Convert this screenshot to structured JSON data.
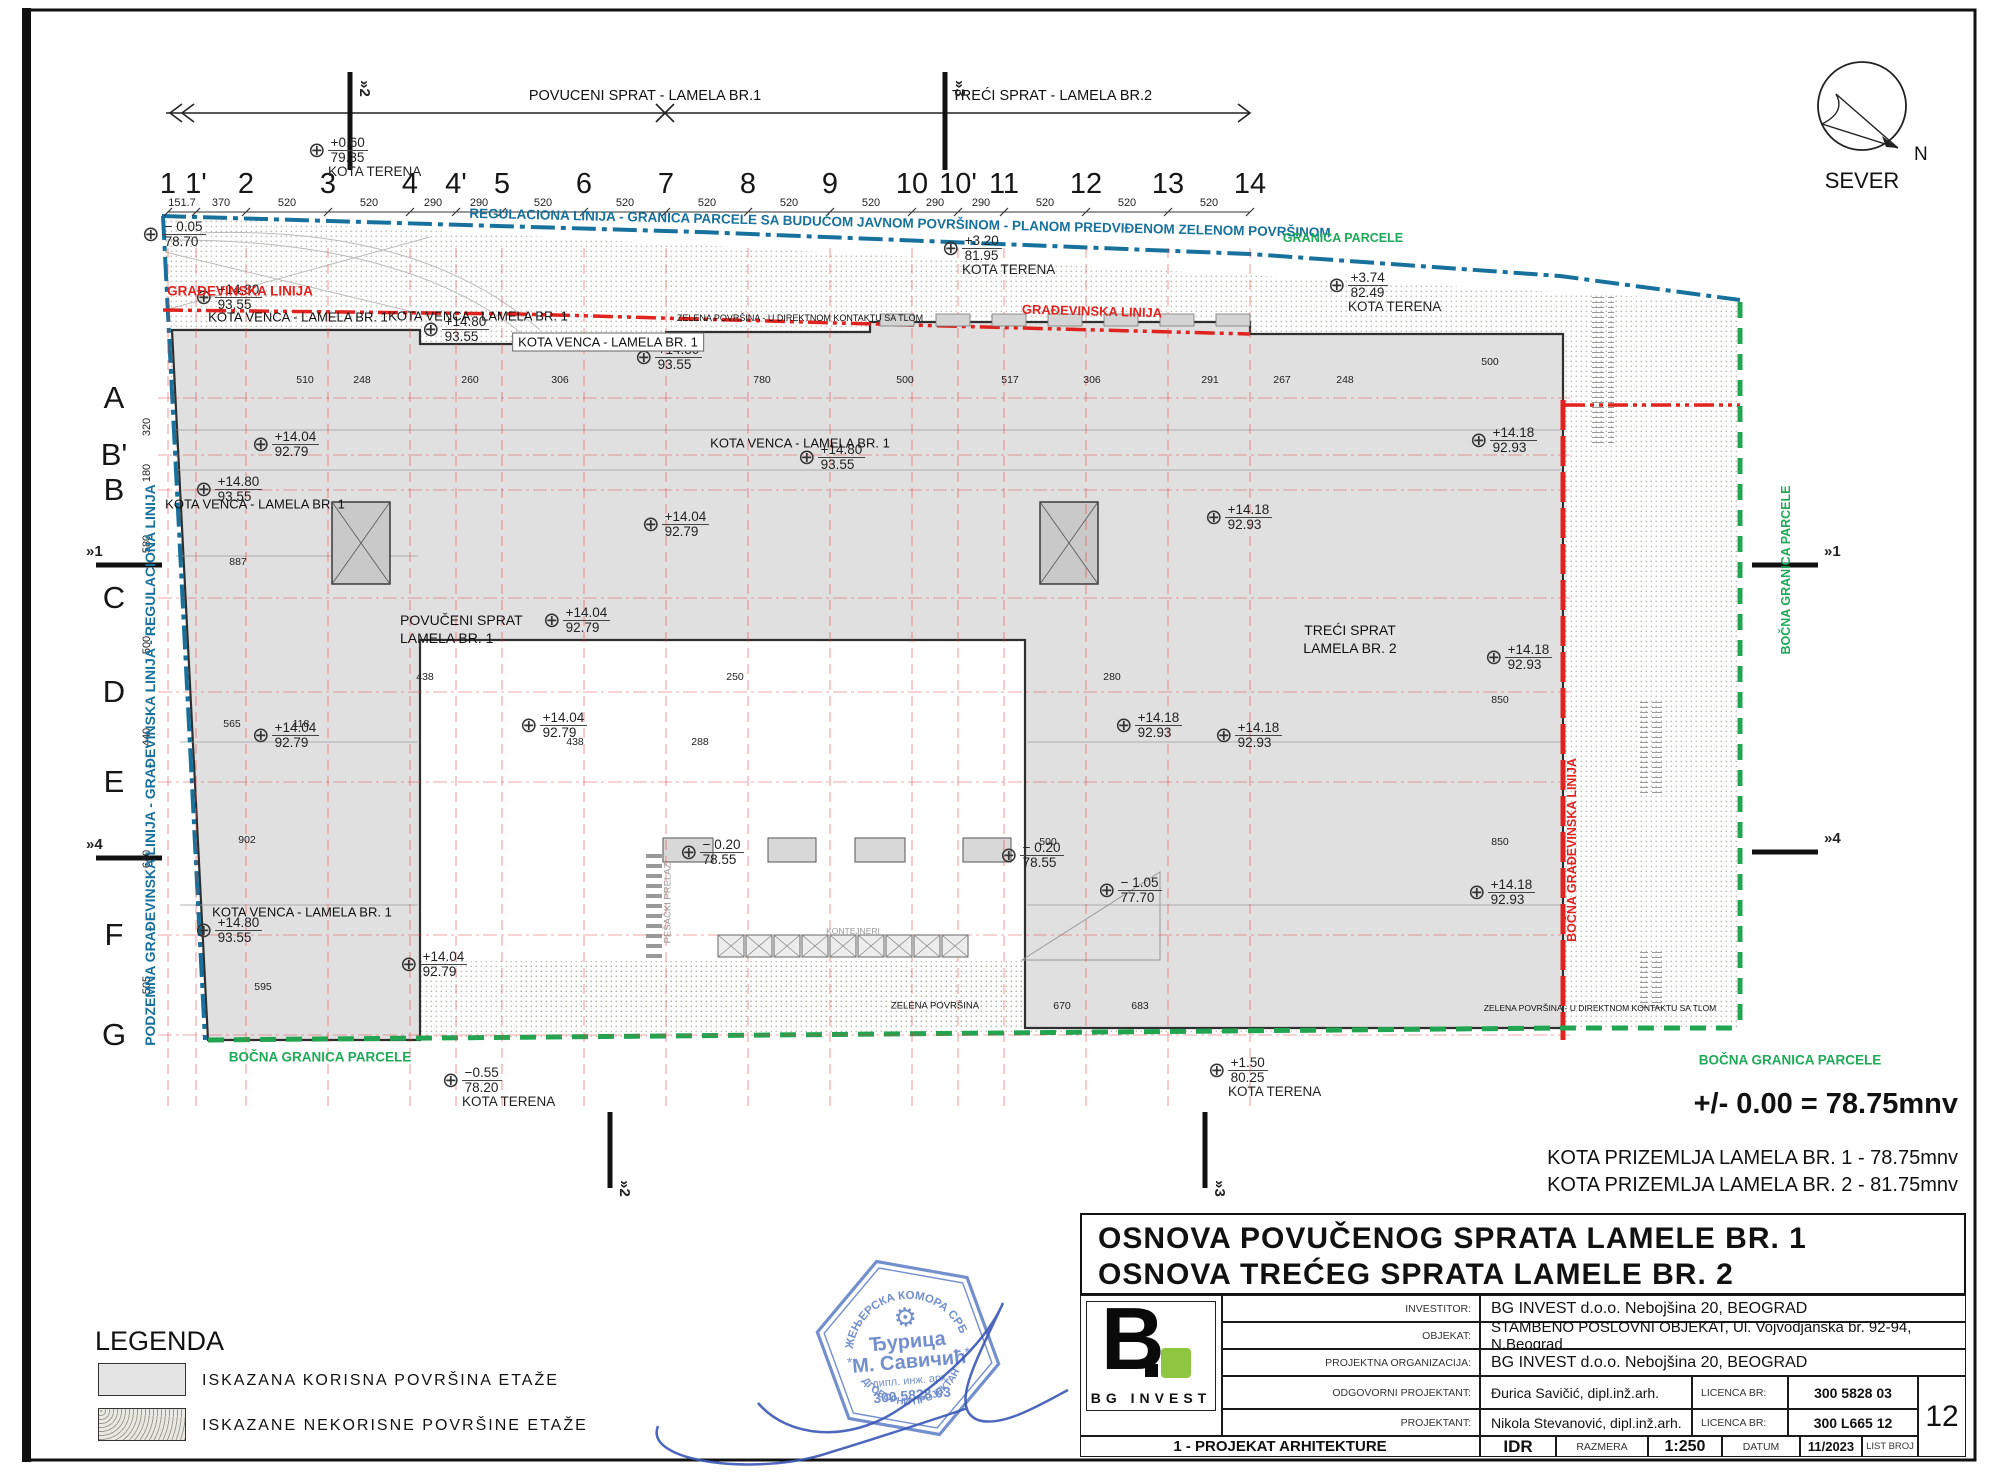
{
  "drawing_titles": {
    "line1": "OSNOVA  POVUČENOG SPRATA LAMELE BR. 1",
    "line2": "OSNOVA  TREĆEG SPRATA LAMELE BR. 2"
  },
  "notes": {
    "datum": "+/- 0.00 = 78.75mnv",
    "kota1": "KOTA PRIZEMLJA LAMELA BR. 1 - 78.75mnv",
    "kota2": "KOTA PRIZEMLJA LAMELA BR. 2 - 81.75mnv"
  },
  "compass": {
    "label": "SEVER",
    "n": "N"
  },
  "legend": {
    "title": "LEGENDA",
    "items": [
      {
        "label": "ISKAZANA  KORISNA  POVRŠINA  ETAŽE",
        "style": "solid"
      },
      {
        "label": "ISKAZANE  NEKORISNE  POVRŠINE  ETAŽE",
        "style": "hatch"
      }
    ]
  },
  "titleblock": {
    "logo_b": "B",
    "logo_name": "BG INVEST",
    "rows": [
      {
        "label": "INVESTITOR:",
        "value": "BG INVEST d.o.o. Nebojšina 20, BEOGRAD"
      },
      {
        "label": "OBJEKAT:",
        "value": "STAMBENO POSLOVNI OBJEKAT, Ul. Vojvodjanska br. 92-94, N.Beograd"
      },
      {
        "label": "PROJEKTNA ORGANIZACIJA:",
        "value": "BG INVEST d.o.o. Nebojšina 20, BEOGRAD"
      },
      {
        "label": "ODGOVORNI PROJEKTANT:",
        "value": "Đurica Savičić, dipl.inž.arh.",
        "lic_label": "LICENCA BR:",
        "lic": "300 5828 03"
      },
      {
        "label": "PROJEKTANT:",
        "value": "Nikola Stevanović, dipl.inž.arh.",
        "lic_label": "LICENCA BR:",
        "lic": "300 L665 12"
      }
    ],
    "bottom": {
      "discipline": "1 - PROJEKAT ARHITEKTURE",
      "idr": "IDR",
      "razmera_label": "RAZMERA",
      "razmera": "1:250",
      "datum_label": "DATUM",
      "datum": "11/2023",
      "list_label": "LIST BROJ",
      "list_broj": "12"
    }
  },
  "stamp": {
    "ring": "ИНЖЕЊЕРСКА КОМОРА СРБИЈЕ",
    "name1": "Ђурица",
    "name2": "М. Савичић",
    "title": "дипл. инж. арх.",
    "number": "300 5828 03",
    "bottom": "ОДГОВОРНИ ПРОЈЕКТАНТ"
  },
  "grid": {
    "cols": [
      [
        "1",
        168
      ],
      [
        "1'",
        196
      ],
      [
        "2",
        246
      ],
      [
        "3",
        328
      ],
      [
        "4",
        410
      ],
      [
        "4'",
        456
      ],
      [
        "5",
        502
      ],
      [
        "6",
        584
      ],
      [
        "7",
        666
      ],
      [
        "8",
        748
      ],
      [
        "9",
        830
      ],
      [
        "10",
        912
      ],
      [
        "10'",
        958
      ],
      [
        "11",
        1004
      ],
      [
        "12",
        1086
      ],
      [
        "13",
        1168
      ],
      [
        "14",
        1250
      ]
    ],
    "col_dims": [
      "151.7",
      "370",
      "520",
      "520",
      "290",
      "290",
      "520",
      "520",
      "520",
      "520",
      "520",
      "290",
      "290",
      "520",
      "520",
      "520"
    ],
    "rows": [
      [
        "A",
        398
      ],
      [
        "B'",
        455
      ],
      [
        "B",
        490
      ],
      [
        "C",
        598
      ],
      [
        "D",
        692
      ],
      [
        "E",
        782
      ],
      [
        "F",
        935
      ],
      [
        "G",
        1035
      ]
    ],
    "row_dims": [
      "320",
      "180",
      "580",
      "500",
      "440",
      "640",
      "505"
    ]
  },
  "section_marks": {
    "top": [
      {
        "x": 350,
        "label": "2"
      },
      {
        "x": 945,
        "label": "3"
      }
    ],
    "bottom": [
      {
        "x": 610,
        "label": "2"
      },
      {
        "x": 1205,
        "label": "3"
      }
    ],
    "left": [
      {
        "y": 565,
        "label": "1"
      },
      {
        "y": 858,
        "label": "4"
      }
    ],
    "right": [
      {
        "y": 565,
        "label": "1"
      },
      {
        "y": 852,
        "label": "4"
      }
    ]
  },
  "elevation_markers": [
    [
      318,
      148,
      "+0.60",
      "79.35",
      "KOTA TERENA"
    ],
    [
      152,
      232,
      "− 0.05",
      "78.70",
      ""
    ],
    [
      952,
      246,
      "+3.20",
      "81.95",
      "KOTA TERENA"
    ],
    [
      1338,
      283,
      "+3.74",
      "82.49",
      "KOTA TERENA"
    ],
    [
      205,
      295,
      "+14.80",
      "93.55",
      ""
    ],
    [
      432,
      327,
      "+14.80",
      "93.55",
      ""
    ],
    [
      645,
      355,
      "+14.80",
      "93.55",
      ""
    ],
    [
      808,
      455,
      "+14.80",
      "93.55",
      ""
    ],
    [
      205,
      487,
      "+14.80",
      "93.55",
      ""
    ],
    [
      205,
      928,
      "+14.80",
      "93.55",
      ""
    ],
    [
      262,
      442,
      "+14.04",
      "92.79",
      ""
    ],
    [
      652,
      522,
      "+14.04",
      "92.79",
      ""
    ],
    [
      553,
      618,
      "+14.04",
      "92.79",
      ""
    ],
    [
      530,
      723,
      "+14.04",
      "92.79",
      ""
    ],
    [
      262,
      733,
      "+14.04",
      "92.79",
      ""
    ],
    [
      410,
      962,
      "+14.04",
      "92.79",
      ""
    ],
    [
      1480,
      438,
      "+14.18",
      "92.93",
      ""
    ],
    [
      1215,
      515,
      "+14.18",
      "92.93",
      ""
    ],
    [
      1495,
      655,
      "+14.18",
      "92.93",
      ""
    ],
    [
      1125,
      723,
      "+14.18",
      "92.93",
      ""
    ],
    [
      1225,
      733,
      "+14.18",
      "92.93",
      ""
    ],
    [
      1478,
      890,
      "+14.18",
      "92.93",
      ""
    ],
    [
      690,
      850,
      "− 0.20",
      "78.55",
      ""
    ],
    [
      1010,
      853,
      "− 0.20",
      "78.55",
      ""
    ],
    [
      1108,
      888,
      "− 1.05",
      "77.70",
      ""
    ],
    [
      452,
      1078,
      "−0.55",
      "78.20",
      "KOTA TERENA"
    ],
    [
      1218,
      1068,
      "+1.50",
      "80.25",
      "KOTA TERENA"
    ]
  ],
  "texts": [
    {
      "n": "regulaciona-linija-label",
      "t": "REGULACIONA LINIJA - GRANICA PARCELE SA BUDUĆOM JAVNOM POVRŠINOM - PLANOM PREDVIĐENOM ZELENOM POVRŠINOM",
      "x": 900,
      "y": 223,
      "s": 13.5,
      "c": "#17719c",
      "r": 1.3,
      "b": true
    },
    {
      "n": "granica-parcele-label",
      "t": "GRANICA PARCELE",
      "x": 1343,
      "y": 238,
      "s": 12.5,
      "c": "#1faa59",
      "b": true
    },
    {
      "n": "gradjevinska-linija-label-left",
      "t": "GRAĐEVINSKA LINIJA",
      "x": 240,
      "y": 291,
      "s": 13.5,
      "c": "#e0231f",
      "b": true
    },
    {
      "n": "gradjevinska-linija-label-right",
      "t": "GRAĐEVINSKA LINIJA",
      "x": 1092,
      "y": 311,
      "s": 13,
      "c": "#e0231f",
      "r": 1.5,
      "b": true
    },
    {
      "n": "podzemna-linija-label",
      "t": "PODZEMNA GRAĐEVINSKA LINIJA - GRAĐEVINSKA LINIJA - REGULACIONA LINIJA",
      "x": 150,
      "y": 765,
      "s": 14,
      "c": "#17719c",
      "r": -90,
      "b": true
    },
    {
      "n": "bocna-granica-parcele-bottom-left",
      "t": "BOČNA GRANICA PARCELE",
      "x": 320,
      "y": 1057,
      "s": 13.5,
      "c": "#1faa59",
      "b": true
    },
    {
      "n": "bocna-granica-parcele-bottom-right",
      "t": "BOČNA GRANICA PARCELE",
      "x": 1790,
      "y": 1060,
      "s": 13.5,
      "c": "#1faa59",
      "b": true
    },
    {
      "n": "bocna-granica-parcele-right-vert",
      "t": "BOČNA GRANICA PARCELE",
      "x": 1786,
      "y": 570,
      "s": 12.5,
      "c": "#1faa59",
      "r": -90,
      "b": true
    },
    {
      "n": "bocna-gradjevinska-linija-vert",
      "t": "BOČNA GRAĐEVINSKA LINIJA",
      "x": 1572,
      "y": 850,
      "s": 12.5,
      "c": "#e0231f",
      "r": -90,
      "b": true
    },
    {
      "n": "zelena-povrsina-kontakt-top",
      "t": "ZELENA POVRŠINA - U DIREKTNOM KONTAKTU SA TLOM",
      "x": 800,
      "y": 318,
      "s": 9
    },
    {
      "n": "zelena-povrsina-kontakt-right",
      "t": "ZELENA POVRŠINA - U DIREKTNOM KONTAKTU SA TLOM",
      "x": 1600,
      "y": 1008,
      "s": 8.5
    },
    {
      "n": "zelena-povrsina-label",
      "t": "ZELENA POVRŠINA",
      "x": 935,
      "y": 1006,
      "s": 9.5
    },
    {
      "n": "kontejneri-label",
      "t": "KONTEJNERI",
      "x": 853,
      "y": 931,
      "s": 8.5,
      "c": "#999999"
    },
    {
      "n": "pesacki-prelaz-label",
      "t": "PEŠAČKI PRELAZ",
      "x": 668,
      "y": 903,
      "s": 9.5,
      "c": "#999999",
      "r": -90
    },
    {
      "n": "kota-venca-label-1",
      "t": "KOTA VENCA - LAMELA BR. 1",
      "x": 298,
      "y": 317,
      "s": 13
    },
    {
      "n": "kota-venca-label-2",
      "t": "KOTA VENCA - LAMELA BR. 1",
      "x": 478,
      "y": 316,
      "s": 13
    },
    {
      "n": "kota-venca-label-3",
      "t": "KOTA VENCA - LAMELA BR. 1",
      "x": 608,
      "y": 342,
      "s": 13,
      "box": true
    },
    {
      "n": "kota-venca-label-4",
      "t": "KOTA VENCA - LAMELA BR. 1",
      "x": 800,
      "y": 443,
      "s": 13
    },
    {
      "n": "kota-venca-label-5",
      "t": "KOTA VENCA - LAMELA BR. 1",
      "x": 255,
      "y": 504,
      "s": 13
    },
    {
      "n": "kota-venca-label-6",
      "t": "KOTA VENCA - LAMELA BR. 1",
      "x": 302,
      "y": 912,
      "s": 13
    },
    {
      "n": "povuceni-sprat-label-line1",
      "t": "POVUČENI SPRAT",
      "x": 400,
      "y": 620,
      "s": 14,
      "a": "l"
    },
    {
      "n": "povuceni-sprat-label-line2",
      "t": "LAMELA BR. 1",
      "x": 400,
      "y": 638,
      "s": 14,
      "a": "l"
    },
    {
      "n": "treci-sprat-label-line1",
      "t": "TREĆI SPRAT",
      "x": 1350,
      "y": 630,
      "s": 14
    },
    {
      "n": "treci-sprat-label-line2",
      "t": "LAMELA BR. 2",
      "x": 1350,
      "y": 648,
      "s": 14
    },
    {
      "n": "top-section-left-label",
      "t": "POVUCENI SPRAT - LAMELA  BR.1",
      "x": 645,
      "y": 96,
      "s": 14.5
    },
    {
      "n": "top-section-right-label",
      "t": "TREĆI SPRAT  - LAMELA  BR.2",
      "x": 1052,
      "y": 96,
      "s": 14.5
    }
  ],
  "misc_dims": [
    [
      "887",
      238,
      562
    ],
    [
      "565",
      232,
      724
    ],
    [
      "118",
      301,
      724
    ],
    [
      "902",
      247,
      840
    ],
    [
      "595",
      263,
      987
    ],
    [
      "670",
      1062,
      1006
    ],
    [
      "683",
      1140,
      1006
    ],
    [
      "850",
      1500,
      700
    ],
    [
      "850",
      1500,
      842
    ],
    [
      "500",
      1048,
      842
    ],
    [
      "438",
      425,
      677
    ],
    [
      "280",
      1112,
      677
    ],
    [
      "510",
      305,
      380
    ],
    [
      "248",
      362,
      380
    ],
    [
      "260",
      470,
      380
    ],
    [
      "306",
      560,
      380
    ],
    [
      "780",
      762,
      380
    ],
    [
      "500",
      905,
      380
    ],
    [
      "517",
      1010,
      380
    ],
    [
      "306",
      1092,
      380
    ],
    [
      "291",
      1210,
      380
    ],
    [
      "267",
      1282,
      380
    ],
    [
      "248",
      1345,
      380
    ],
    [
      "500",
      1490,
      362
    ],
    [
      "438",
      575,
      742
    ],
    [
      "288",
      700,
      742
    ],
    [
      "250",
      735,
      677
    ]
  ],
  "colors": {
    "regulation_blue": "#17719c",
    "building_red": "#e0231f",
    "parcel_green": "#1faa59",
    "building_fill": "#e0e0e0",
    "logo_green": "#8ec641",
    "stamp_blue": "#5b7cc4"
  }
}
